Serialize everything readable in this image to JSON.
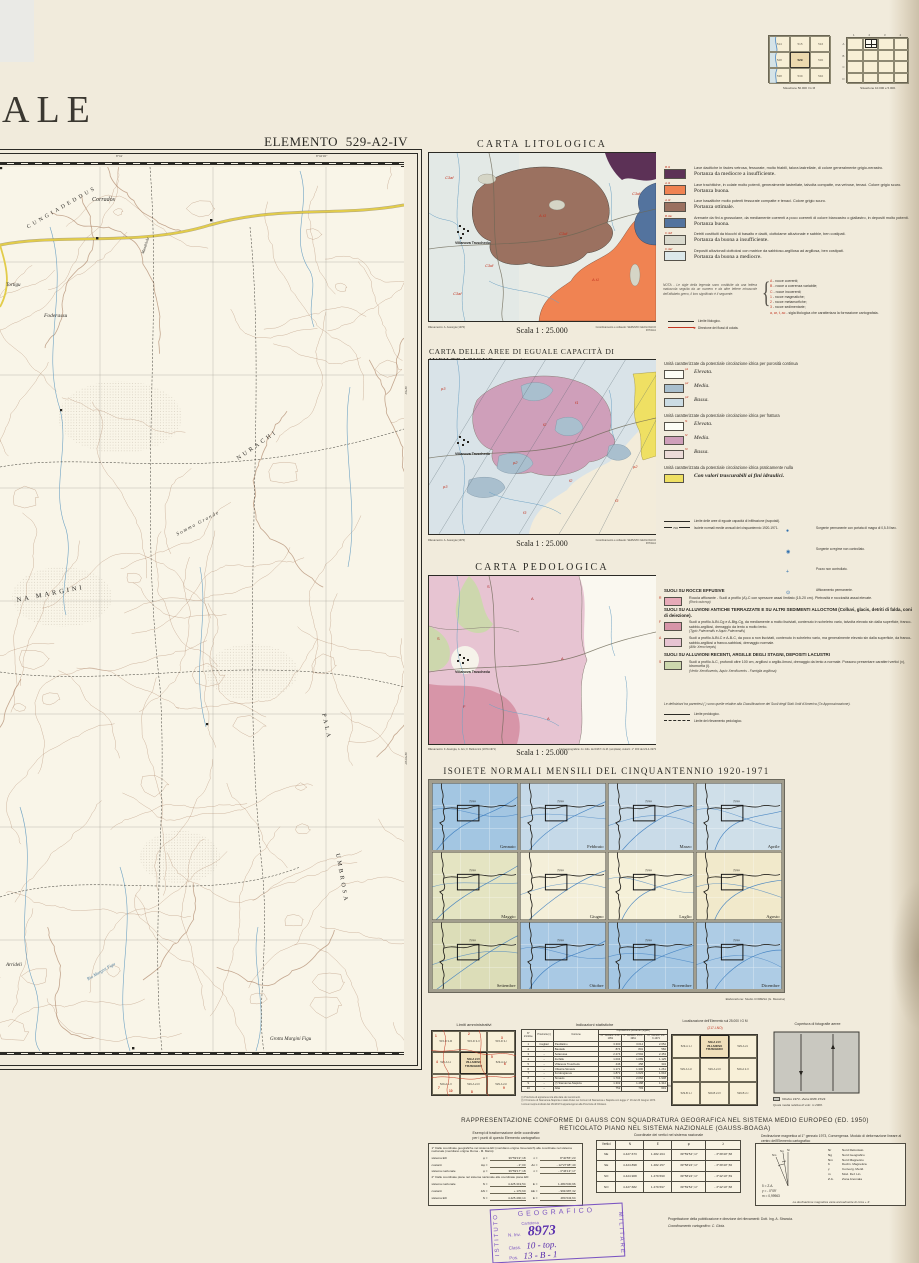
{
  "page": {
    "title_fragment": "ALE",
    "element_title": "ELEMENTO  529-A2-IV"
  },
  "situazione": {
    "left": {
      "caption": "Situazione 50.000 I G M",
      "cells": [
        "514",
        "515",
        "516",
        "528",
        "529",
        "530",
        "538",
        "539",
        "540"
      ],
      "highlight": "529"
    },
    "right": {
      "caption": "Situazione 10.000 e 5.000.",
      "cols": [
        "1",
        "2",
        "3",
        "4"
      ],
      "rows": [
        "A",
        "B",
        "C",
        "D"
      ]
    }
  },
  "main_map": {
    "labels": [
      "Corradòs",
      "CUNGIADEDDUS",
      "Mandriola",
      "Tortigu",
      "Foderassu",
      "NURACHI",
      "Somma Grande",
      "NA MARGINI",
      "PALA",
      "UMBROSA",
      "Arrideli",
      "Grotta Margini Figu",
      "Riu Margini Figu"
    ],
    "edge_labels": [
      "8°41'",
      "8°42'30''",
      "39°59'",
      "39°58'30''"
    ],
    "footer": "Collaudo del rilevamento topografico: I.G.M. - F. Lombardi - A. Pelusio."
  },
  "maps": {
    "town": "Villanova Truschedu",
    "scala": "Scala 1 : 25.000",
    "rilevamento": "Rilevamento: A. Assorgia (1970)",
    "coordinamento": "Coordinamento e collaudo: SERVIZIO GEOLOGICO D'ITALIA"
  },
  "litologica": {
    "title": "CARTA LITOLOGICA",
    "legend": [
      {
        "code": "B.t1",
        "color": "#5c3156",
        "desc": "Lave dacitiche in facies vetrosa, fessurate, molto friabili, talora lastrellate, di colore generalmente grigio-nerastro.",
        "port": "Portanza da mediocre a insufficiente."
      },
      {
        "code": "A.t1",
        "color": "#f08352",
        "desc": "Lave trachitiche, in colate molto potenti, generalmente lastrellate, talvolta compatte, ma vetrose, tenaci. Colore grigio scuro.",
        "port": "Portanza buona."
      },
      {
        "code": "A.t3",
        "color": "#9b7160",
        "desc": "Lave basaltiche molto potenti fessurate compatte e tenaci. Colore grigio scuro.",
        "port": "Portanza ottimale."
      },
      {
        "code": "B.3ar",
        "color": "#53739e",
        "dots": true,
        "desc": "Arenarie da fini a grossolane, da mediamente coerenti a poco coerenti di colore biancastro o giallastro, in depositi molto potenti.",
        "port": "Portanza buona."
      },
      {
        "code": "C.3dl",
        "color": "#d9d9cd",
        "desc": "Detriti costituiti da blocchi di basalto e daciti, ciottolame alluvionale e sabbie, ben costipati.",
        "port": "Portanza da buona a insufficiente."
      },
      {
        "code": "C.3af",
        "color": "#dce8ea",
        "desc": "Depositi alluvionali ciottolosi con matrice da sabbioso-argillosa ad argillosa, ben costipati.",
        "port": "Portanza da buona a mediocre."
      }
    ],
    "nota": "NOTA - Le sigle della legenda sono costituite da una lettera maiuscola seguita da un numero e da altre lettere minuscole dell'alfabeto greco, il loro significato è il seguente:",
    "classlist": [
      {
        "k": "A",
        "v": "rocce coerenti;"
      },
      {
        "k": "B",
        "v": "rocce a coerenza variabile;"
      },
      {
        "k": "C",
        "v": "rocce incoerenti;"
      },
      {
        "k": "1",
        "v": "rocce magmatiche;"
      },
      {
        "k": "2",
        "v": "rocce metamorfiche;"
      },
      {
        "k": "3",
        "v": "rocce sedimentarie;"
      },
      {
        "k": "a, ar, t, ac",
        "v": "sigla litologica che caratterizza la formazione cartografata."
      }
    ],
    "symbols": [
      {
        "ic": "line",
        "label": "Limite litologico."
      },
      {
        "ic": "arrow",
        "label": "Direzione dei flussi di colata."
      }
    ],
    "map_labels": [
      "C3af",
      "A.t3",
      "C3dl",
      "A.t1",
      "C3dl",
      "C3af",
      "C3dl"
    ]
  },
  "infiltrazione": {
    "title": "CARTA DELLE AREE DI EGUALE CAPACITÀ DI INFILTRAZIONE",
    "title_suffix": "(Isopotali)",
    "h_porosita": "Unità caratterizzate da potenziale circolazione idrica per porosità continua",
    "h_frattura": "Unità caratterizzate da potenziale circolazione idrica per frattura",
    "h_nulla": "Unità caratterizzata da potenziale circolazione idrica praticamente nulla",
    "items_p": [
      {
        "code": "p1",
        "color": "#fdfdf6",
        "label": "Elevata."
      },
      {
        "code": "p2",
        "color": "#a9bfce",
        "label": "Media."
      },
      {
        "code": "p3",
        "color": "#ccdce4",
        "label": "Bassa."
      }
    ],
    "items_f": [
      {
        "code": "f1",
        "color": "#fdfdf6",
        "label": "Elevata."
      },
      {
        "code": "f2",
        "color": "#cf9fba",
        "label": "Media."
      },
      {
        "code": "f3",
        "color": "#ecdbd8",
        "label": "Bassa."
      }
    ],
    "nulla_color": "#efe063",
    "nulla_label": "Con valori trascurabili ai fini idraulici.",
    "iso_value": "700",
    "symbols_left": [
      {
        "ic": "line",
        "label": "Limite delle aree di eguale capacità di infiltrazione (isopotali)."
      },
      {
        "ic": "iso",
        "label": "Isoiete normali medie annuali del cinquantennio 1920-1971."
      }
    ],
    "symbols_right": [
      {
        "ic": "spring",
        "label": "Sorgente permanente con portata di magra di 0,5-5 l/sec."
      },
      {
        "ic": "spring2",
        "label": "Sorgente a regime non controllato."
      },
      {
        "ic": "plus",
        "label": "Pozzo non controllato."
      },
      {
        "ic": "ring",
        "label": "Affioramento permanente."
      }
    ],
    "map_labels": [
      "p3",
      "f1",
      "f2",
      "p2",
      "f2",
      "p3",
      "f3",
      "f3",
      "p2"
    ]
  },
  "pedologica": {
    "title": "CARTA PEDOLOGICA",
    "blocks": [
      {
        "h": "SUOLI SU ROCCE EFFUSIVE"
      },
      {
        "code": "R",
        "color": "#e7aab8",
        "desc": "Roccia affiorante - Suoli a profilo (A)-C con spessore assai limitato (15-20 cm). Pietrosità e rocciosità assai elevate.",
        "it": "(Rock outcrop)"
      },
      {
        "h": "SUOLI SU ALLUVIONI ANTICHE TERRAZZATE E SU ALTRI SEDIMENTI ALLOCTONI (Colluvi, glacis, detriti di falda, coni di deiezione)."
      },
      {
        "code": "F",
        "color": "#d795a8",
        "desc": "Suoli a profilo A-Bt-Cg e A-Btg-Cg, da mediamente a molto lisciviati, contenuto in scheletro vario, talvolta elevato sin dalla superficie, franco-sabbio-argillosi, drenaggio da lento a molto lento.",
        "it": "(Typic Palexeralfs e Aquic Palexeralfs)"
      },
      {
        "code": "A",
        "color": "#e7c4d2",
        "desc": "Suoli a profilo A-Bt-C e A-B-C, da poco a non lisciviati, contenuto in scheletro vario, ma generalmente elevato sin dalla superficie, da franco-sabbio-argillosi a franco-sabbiosi, drenaggio normale.",
        "it": "(Alfic Xerochrepts)"
      },
      {
        "h": "SUOLI SU ALLUVIONI RECENTI, ARGILLE DEGLI STAGNI, DEPOSITI LACUSTRI"
      },
      {
        "code": "S",
        "color": "#cdd7ad",
        "desc": "Suoli a profilo A-C, profondi oltre 100 cm, argillosi o argillo-limosi, drenaggio da lento a normale. Possono presentare caratteri vertici (v), idromorfia (i).",
        "it": "(Vertic Xerofluvents, Aquic Xerofluvents - Famiglia argillosa)"
      }
    ],
    "note": "Le definizioni tra parentesi ( ) sono quelle relative alla Classificazione dei Suoli degli Stati Uniti d'America (7a Approssimazione).",
    "symbols": [
      {
        "ic": "line",
        "label": "Limite pedologico."
      },
      {
        "ic": "dashdot",
        "label": "Limite del rilevamento pedologico."
      }
    ],
    "rilevamento": "Rilevamento: F. Assorgia, A. Aru; F. Belluomini (1970-1971)",
    "fonte": "Fonte topografica: riv. ridis. del 1967 I.G.M. (ampliata). Autoriz. n° 303 del 23-4-1973",
    "map_labels": [
      "S",
      "A",
      "S",
      "A",
      "F",
      "A"
    ]
  },
  "isoiete": {
    "title": "ISOIETE NORMALI MENSILI DEL CINQUANTENNIO 1920-1971",
    "credit": "Elaborazione: Studio COMESA (G. Messina)",
    "river": "Tirso",
    "months": [
      {
        "name": "Gennaio",
        "color": "#a3c6e2"
      },
      {
        "name": "Febbraio",
        "color": "#c5d9e8"
      },
      {
        "name": "Marzo",
        "color": "#c9dbe8"
      },
      {
        "name": "Aprile",
        "color": "#cfdfe9"
      },
      {
        "name": "Maggio",
        "color": "#e4e4c2"
      },
      {
        "name": "Giugno",
        "color": "#f4efd9"
      },
      {
        "name": "Luglio",
        "color": "#f5f0d8"
      },
      {
        "name": "Agosto",
        "color": "#f1e9cb"
      },
      {
        "name": "Settembre",
        "color": "#dcddb8"
      },
      {
        "name": "Ottobre",
        "color": "#a9c9e4"
      },
      {
        "name": "Novembre",
        "color": "#a5c7e3"
      },
      {
        "name": "Dicembre",
        "color": "#aecce5"
      }
    ]
  },
  "bottom": {
    "limiti": {
      "title": "Limiti amministrativi",
      "cells": [
        "515-D 3-III",
        "515-D 3-II",
        "515-D 3-I",
        "529-A 1-I",
        "529-A 2-IV\nVILLANOVA\nTRUSCHEDU",
        "529-A 2-I",
        "529-A 1-II",
        "529-A 2-III",
        "529-A 2-II"
      ],
      "numbers": [
        "1",
        "2",
        "3",
        "4",
        "5",
        "6",
        "7",
        "8",
        "9",
        "10"
      ]
    },
    "stats": {
      "title": "Indicazioni statistiche",
      "header": {
        "n": "N° d'ordine",
        "prov": "Provincia (¹)",
        "com": "Comune",
        "pop": "Popolazione presente (legale)",
        "c1": "IX° Censim. 4-XI-1951",
        "c2": "X° Censim. 15-X-1961",
        "c3": "XI° Censim. 24-X-1971"
      },
      "rows": [
        [
          "1",
          "Cagliari",
          "Paulilatino",
          "3.300",
          "3.014",
          "2.652"
        ],
        [
          "2",
          "–",
          "Bauladu",
          "874",
          "801",
          "582"
        ],
        [
          "3",
          "–",
          "Solarussa",
          "2.274",
          "2.594",
          "2.453"
        ],
        [
          "4",
          "–",
          "Zerfaliu",
          "1.004",
          "1.089",
          "1.125"
        ],
        [
          "5",
          "–",
          "Villanova Truschedu",
          "446",
          "458",
          "334"
        ],
        [
          "6",
          "–",
          "Ollastra Simaxis",
          "1.171",
          "1.300",
          "1.261"
        ],
        [
          "7",
          "–",
          "Fordongianus",
          "1.871",
          "1.623",
          "1.644"
        ],
        [
          "8",
          "–",
          "Simaxis",
          "1.704",
          "2.062",
          "1.908"
        ],
        [
          "9",
          "–",
          "(²) Siamanna-Siapicia",
          "1.302",
          "1.488",
          "1.312"
        ],
        [
          "10",
          "–",
          "Allai",
          "752",
          "793",
          "601"
        ]
      ],
      "footnotes": [
        "(¹) Provincia di appartenenza alla data dei censimenti.",
        "(²) Il Comune di Siamanna-Siapicia è stato diviso nei Comuni di Siamanna e Siapicia con legge n° 16 del 20 Giugno 1974.",
        "I comuni sopra indicati dal 16/4/1974 appartengono alla Provincia di Oristano."
      ]
    },
    "localizzazione": {
      "title": "Localizzazione dell'Elemento sul 25.000 I G M",
      "code": "(217-I-NO)",
      "cells": [
        "529-A 1-I",
        "529-A 2-IV\nVILLANOVA\nTRUSCHEDU",
        "529-A 2-I",
        "529-A 1-II",
        "529-A 2-III",
        "529-A 2-II",
        "529-B 1-I",
        "529-B 2-IV",
        "529-B 2-I"
      ]
    },
    "copertura": {
      "title": "Copertura di fotografie aeree",
      "caption1": "Ottobre 1973 - Zeiss RMK 15/23.",
      "caption2": "Quota media relativa di volo: m 2000."
    }
  },
  "gauss": {
    "line1": "RAPPRESENTAZIONE CONFORME DI GAUSS CON SQUADRATURA GEOGRAFICA NEL SISTEMA MEDIO EUROPEO (ED. 1950)",
    "line2": "RETICOLATO PIANO NEL SISTEMA NAZIONALE (GAUSS-BOAGA)",
    "decl_head": "Declinazione magnetica al 1° gennaio 1973, Convergenza. Modulo di deformazione lineare al centro dell'Elemento cartografico",
    "esempi": {
      "title1": "Esempi di trasformazione delle coordinate",
      "title2": "per i punti di questo Elemento cartografico",
      "p1": "1° Dalle coordinate geografiche nel sistema ED (meridiano origine Greenwich) alle coordinate nel sistema nazionale (meridiano origine Roma - M. Mario):",
      "rows1": [
        [
          "sistema ED",
          "φ =",
          "39°59'19\",18",
          "λ =",
          "8°40'55\",23"
        ],
        [
          "costanti",
          "Δφ =",
          "- 2\",00",
          "Δλ =",
          "- 12°27'08\",40"
        ],
        [
          "sistema nazionale",
          "φ =",
          "39°59'17\",18",
          "λ =",
          "- 3°46'13\",17"
        ]
      ],
      "p2": "2° Dalle coordinate piane nel sistema nazionale alle coordinate piane ED:",
      "rows2": [
        [
          "sistema nazionale",
          "N =",
          "4.425.319,54",
          "E =",
          "1.480.530,96"
        ],
        [
          "costanti",
          "ΔN =",
          "+ 170,60",
          "ΔE =",
          "- 999.987,32"
        ],
        [
          "sistema ED",
          "N =",
          "4.425.490,14",
          "E =",
          "480.543,64"
        ]
      ]
    },
    "coord_title": "Coordinate dei vertici nel sistema nazionale",
    "vertici_header": [
      "Vertici",
      "N",
      "E",
      "φ",
      "λ"
    ],
    "vertici": [
      [
        "NE",
        "4.427.673",
        "1.482.164",
        "39°59'54\",17",
        "- 3°39'40\",58"
      ],
      [
        "SE",
        "4.424.898",
        "1.482.157",
        "39°58'24\",17",
        "- 3°39'40\",56"
      ],
      [
        "SO",
        "4.424.908",
        "1.479.590",
        "39°58'24\",17",
        "- 3°42'10\",59"
      ],
      [
        "NO",
        "4.427.682",
        "1.479.597",
        "39°59'54\",17",
        "- 3°42'10\",58"
      ]
    ],
    "decl": {
      "legend": [
        {
          "k": "Nr",
          "v": "Nord Reticolato"
        },
        {
          "k": "Ng",
          "v": "Nord Geografico"
        },
        {
          "k": "Nm",
          "v": "Nord Magnetico"
        },
        {
          "k": "δ",
          "v": "Declin. Magnetica"
        },
        {
          "k": "γ",
          "v": "Converg. Merid."
        },
        {
          "k": "m",
          "v": "Mod. Def. Lin."
        },
        {
          "k": "Z.A.",
          "v": "Zona Anomala"
        }
      ],
      "values": [
        "δ = Z.A.",
        "γ = - 0°09'",
        "m = 0,99963"
      ],
      "footnote": "La declinazione magnetica varia annualmente di circa + 4'."
    }
  },
  "stamp": {
    "top": "GEOGRAFICO",
    "left": "ISTITUTO",
    "right": "MILITARE",
    "line1": "Cartoteca",
    "inv_label": "N. Inv.",
    "inv": "8973",
    "class_label": "Class.",
    "class": "10 - top.",
    "pos_label": "Pos.",
    "pos": "13 - B - 1"
  },
  "credits": {
    "line1": "Progettazione della pubblicazione e direzione dei rilevamenti: Dott. Ing. A. Strancia.",
    "line2": "Coordinamento cartografico: C. Gioia."
  }
}
